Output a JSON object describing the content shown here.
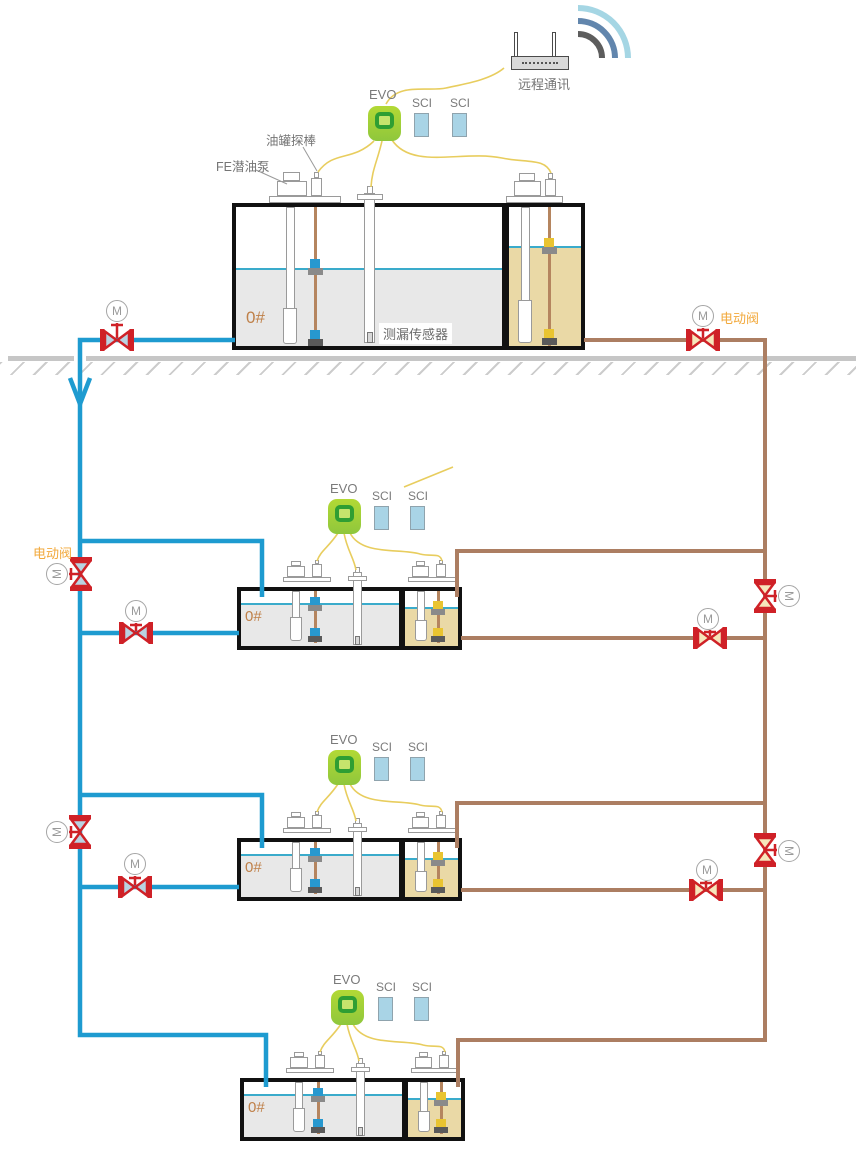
{
  "title": "油站油罐监控系统示意图",
  "device": {
    "evo_label": "EVO",
    "sci_label": "SCI",
    "router_label": "远程通讯"
  },
  "labels": {
    "valve_m": "M",
    "electric_valve": "电动阀",
    "fe_pump": "FE潜油泵",
    "tank_probe": "油罐探棒",
    "leak_sensor": "测漏传感器",
    "fuel_grade": "0#",
    "remote_comm": "远程通讯"
  },
  "stations": [
    {
      "name": "主油罐站",
      "fuel_grade": "0#",
      "console": "EVO",
      "modules": [
        "SCI",
        "SCI"
      ]
    },
    {
      "name": "油罐站2",
      "fuel_grade": "0#",
      "console": "EVO",
      "modules": [
        "SCI",
        "SCI"
      ]
    },
    {
      "name": "油罐站3",
      "fuel_grade": "0#",
      "console": "EVO",
      "modules": [
        "SCI",
        "SCI"
      ]
    },
    {
      "name": "油罐站4",
      "fuel_grade": "0#",
      "console": "EVO",
      "modules": [
        "SCI",
        "SCI"
      ]
    }
  ],
  "colors": {
    "supply_pipe_blue": "#1e9bd0",
    "return_pipe_brown": "#ac7e62",
    "valve_red": "#cf2127",
    "valve_fill_blue_side": "#b9d3e2",
    "valve_fill_brown_side": "#f6e6bb",
    "wire_yellow": "#e8cd5e",
    "evo_green": "#9ed338",
    "sci_blue": "#a9d4e6",
    "fuel_gray": "#e8e8e8",
    "fuel_tan": "#ead9a6",
    "liquid_line_cyan": "#3aabcb",
    "electric_valve_label_orange": "#f2a93c",
    "fuel_grade_orange": "#bf8049",
    "ground_gray": "#c6c6c6"
  }
}
